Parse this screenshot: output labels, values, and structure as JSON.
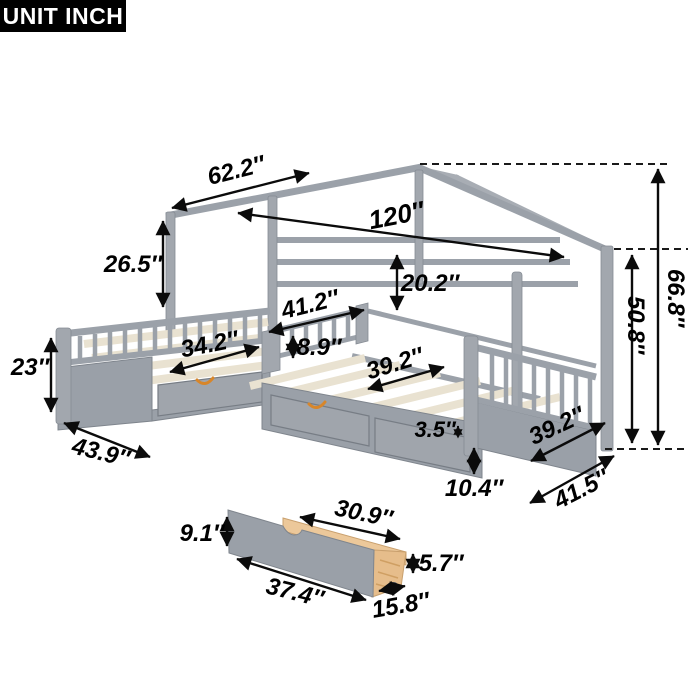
{
  "badge": {
    "label": "UNIT INCH"
  },
  "palette": {
    "frame_gray": "#9ba1a9",
    "panel_gray": "#9aa0a8",
    "slat_cream": "#e9e2d1",
    "wood_tan": "#ecc89a",
    "handle_orange": "#d8862a",
    "annotation_black": "#0b0b0b",
    "background": "#ffffff"
  },
  "annotations": {
    "roof_slope_width": {
      "value": "62.2″"
    },
    "overall_length": {
      "value": "120″"
    },
    "head_frame_height": {
      "value": "26.5″"
    },
    "wall_rail_height": {
      "value": "20.2″"
    },
    "inner_bed_width": {
      "value": "41.2″"
    },
    "guardrail_height": {
      "value": "8.9″"
    },
    "left_slat_width": {
      "value": "34.2″"
    },
    "right_slat_width": {
      "value": "39.2″"
    },
    "left_side_height": {
      "value": "23″"
    },
    "left_end_depth": {
      "value": "43.9″"
    },
    "deck_drawer_gap": {
      "value": "3.5″"
    },
    "drawer_band_height": {
      "value": "10.4″"
    },
    "foot_slat_width": {
      "value": "39.2″"
    },
    "foot_end_depth": {
      "value": "41.5″"
    },
    "eave_height": {
      "value": "50.8″"
    },
    "peak_height": {
      "value": "66.8″"
    },
    "drawer_total_height": {
      "value": "9.1″"
    },
    "drawer_top_width": {
      "value": "30.9″"
    },
    "drawer_side_height": {
      "value": "5.7″"
    },
    "drawer_front_width": {
      "value": "37.4″"
    },
    "drawer_depth": {
      "value": "15.8″"
    }
  }
}
